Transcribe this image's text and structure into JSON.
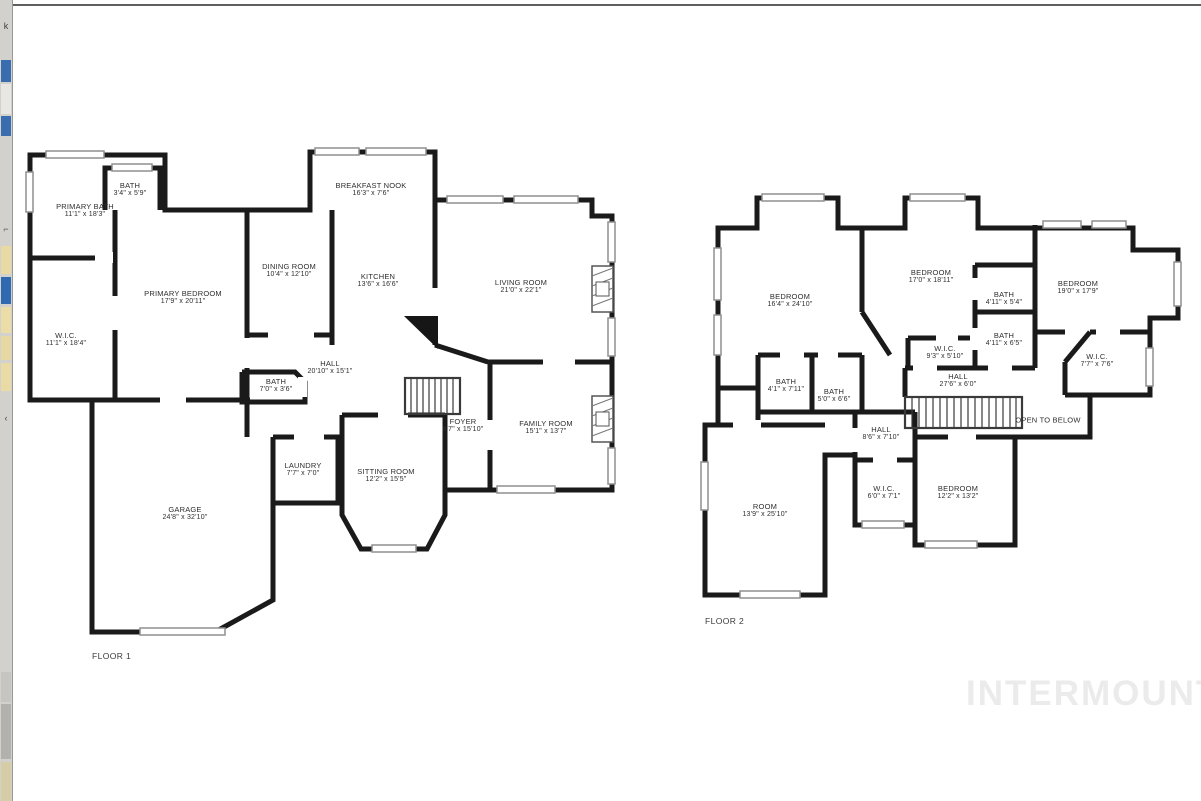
{
  "canvas": {
    "background": "#ffffff",
    "wall_color": "#1a1a1a",
    "window_color": "#8f8f8f",
    "top_border_color": "#5f5f5f"
  },
  "left_strip": {
    "background": "#d3d1ce",
    "blocks": [
      {
        "top": 22,
        "height": 14,
        "color": "#44413d",
        "kind": "glyph-mark",
        "char": "k"
      },
      {
        "top": 60,
        "height": 22,
        "color": "#3a6cb0",
        "kind": "thumbnail"
      },
      {
        "top": 84,
        "height": 30,
        "color": "#e9e7e3",
        "kind": "thumbnail"
      },
      {
        "top": 116,
        "height": 20,
        "color": "#3a6cb0",
        "kind": "thumbnail"
      },
      {
        "top": 225,
        "height": 12,
        "color": "#5e5b57",
        "kind": "glyph-mark",
        "char": "⌐"
      },
      {
        "top": 246,
        "height": 28,
        "color": "#e9d9a2",
        "kind": "thumbnail"
      },
      {
        "top": 277,
        "height": 27,
        "color": "#2f69b2",
        "kind": "thumbnail"
      },
      {
        "top": 307,
        "height": 26,
        "color": "#ecdca6",
        "kind": "thumbnail"
      },
      {
        "top": 336,
        "height": 24,
        "color": "#e7d7a2",
        "kind": "thumbnail"
      },
      {
        "top": 363,
        "height": 28,
        "color": "#eadaa4",
        "kind": "thumbnail"
      },
      {
        "top": 414,
        "height": 16,
        "color": "#4a4a4a",
        "kind": "collapse-arrow",
        "char": "‹"
      },
      {
        "top": 672,
        "height": 30,
        "color": "#c7c5c2",
        "kind": "thumbnail"
      },
      {
        "top": 704,
        "height": 55,
        "color": "#b3b1ae",
        "kind": "thumbnail"
      },
      {
        "top": 762,
        "height": 39,
        "color": "#d6cda6",
        "kind": "thumbnail"
      }
    ]
  },
  "watermark": {
    "text": "INTERMOUNTAIN",
    "color": "#ebebeb"
  },
  "floor1": {
    "label": "FLOOR 1",
    "rooms": [
      {
        "name": "PRIMARY BATH",
        "dims": "11'1\" x 18'3\""
      },
      {
        "name": "BATH",
        "dims": "3'4\" x 5'9\""
      },
      {
        "name": "PRIMARY BEDROOM",
        "dims": "17'9\" x 20'11\""
      },
      {
        "name": "W.I.C.",
        "dims": "11'1\" x 18'4\""
      },
      {
        "name": "DINING ROOM",
        "dims": "10'4\" x 12'10\""
      },
      {
        "name": "BREAKFAST NOOK",
        "dims": "16'3\" x 7'6\""
      },
      {
        "name": "KITCHEN",
        "dims": "13'6\" x 16'6\""
      },
      {
        "name": "LIVING ROOM",
        "dims": "21'0\" x 22'1\""
      },
      {
        "name": "BATH",
        "dims": "7'0\" x 3'6\""
      },
      {
        "name": "HALL",
        "dims": "20'10\" x 15'1\""
      },
      {
        "name": "FOYER",
        "dims": "8'7\" x 15'10\""
      },
      {
        "name": "FAMILY ROOM",
        "dims": "15'1\" x 13'7\""
      },
      {
        "name": "LAUNDRY",
        "dims": "7'7\" x 7'0\""
      },
      {
        "name": "SITTING ROOM",
        "dims": "12'2\" x 15'5\""
      },
      {
        "name": "GARAGE",
        "dims": "24'8\" x 32'10\""
      }
    ]
  },
  "floor2": {
    "label": "FLOOR 2",
    "open_to_below": "OPEN TO BELOW",
    "rooms": [
      {
        "name": "BEDROOM",
        "dims": "16'4\" x 24'10\""
      },
      {
        "name": "BEDROOM",
        "dims": "17'0\" x 18'11\""
      },
      {
        "name": "BATH",
        "dims": "4'11\" x 5'4\""
      },
      {
        "name": "BEDROOM",
        "dims": "19'0\" x 17'9\""
      },
      {
        "name": "BATH",
        "dims": "4'11\" x 6'5\""
      },
      {
        "name": "W.I.C.",
        "dims": "9'3\" x 5'10\""
      },
      {
        "name": "W.I.C.",
        "dims": "7'7\" x 7'6\""
      },
      {
        "name": "HALL",
        "dims": "27'6\" x 6'0\""
      },
      {
        "name": "BATH",
        "dims": "4'1\" x 7'11\""
      },
      {
        "name": "BATH",
        "dims": "5'0\" x 6'6\""
      },
      {
        "name": "HALL",
        "dims": "8'6\" x 7'10\""
      },
      {
        "name": "W.I.C.",
        "dims": "6'0\" x 7'1\""
      },
      {
        "name": "BEDROOM",
        "dims": "12'2\" x 13'2\""
      },
      {
        "name": "ROOM",
        "dims": "13'9\" x 25'10\""
      }
    ]
  }
}
